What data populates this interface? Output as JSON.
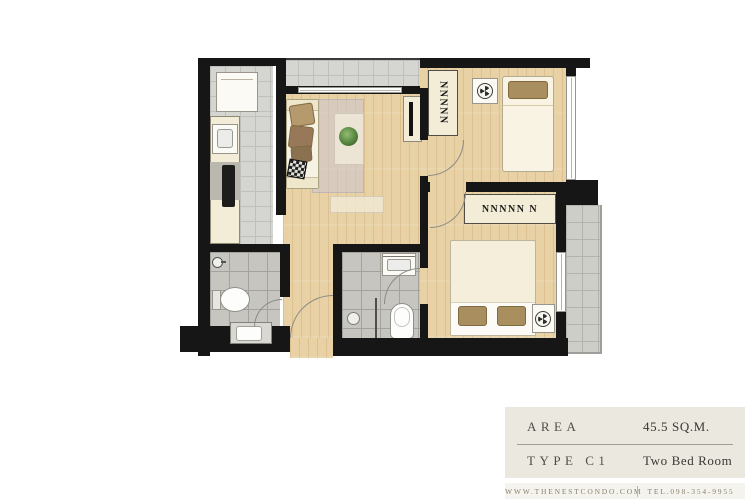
{
  "info_panel": {
    "rows": [
      {
        "label": "AREA",
        "value": "45.5  SQ.M."
      },
      {
        "label": "TYPE C1",
        "value": "Two Bed Room"
      }
    ]
  },
  "footer": {
    "website": "WWW.THENESTCONDO.COM",
    "phone": "TEL.098-354-9955"
  },
  "floorplan": {
    "bedroom1_wardrobe_marks": "NNNNN",
    "bedroom2_wardrobe_marks": "NNNNN N",
    "icons": {
      "fan": "ceiling-fan-icon",
      "shower": "shower-head-icon",
      "plant": "potted-plant-icon"
    },
    "colors": {
      "wall": "#161616",
      "wood_floor": "#e8d1a5",
      "tile_floor": "#d5d5d1",
      "bathroom_tile": "#c6c5c0",
      "furniture_cream": "#f3edd8",
      "cushion_brown": "#a98e60",
      "rug": "#cfc9d4",
      "plant_green": "#4e7d38",
      "panel_background": "#ebe8e0"
    }
  }
}
